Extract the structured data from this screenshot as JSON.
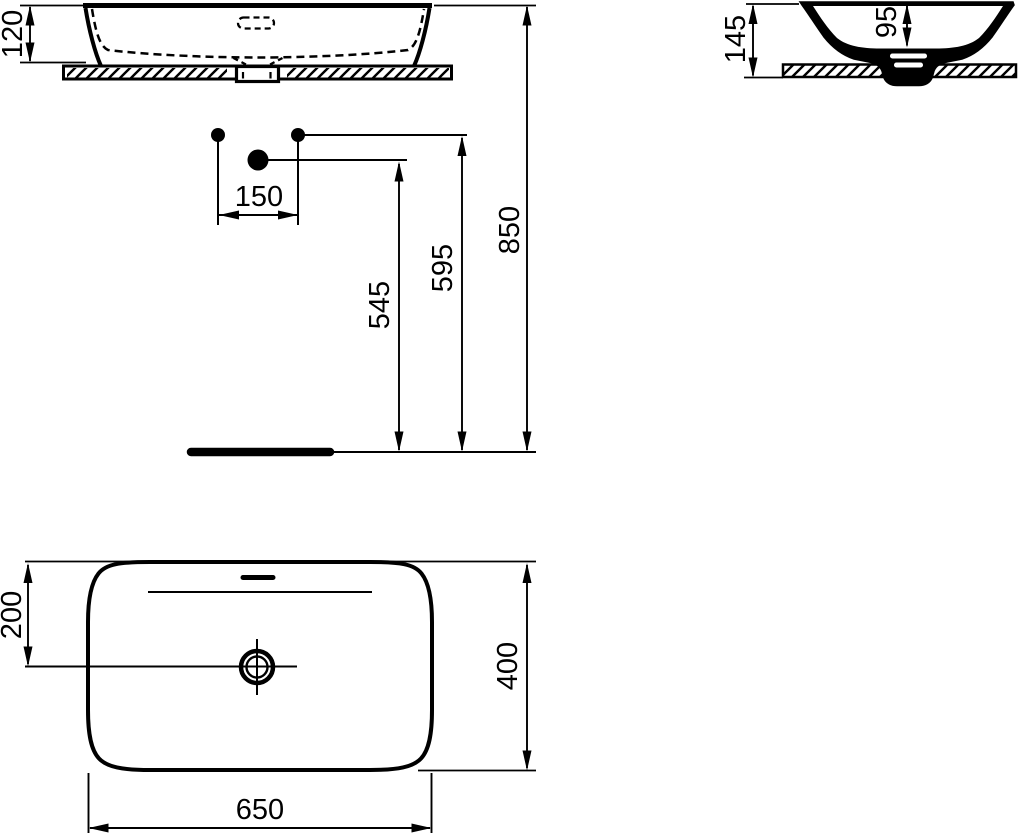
{
  "drawing": {
    "line_color": "#000000",
    "background": "#ffffff",
    "dims": {
      "rim_to_counter": "120",
      "overall_height": "145",
      "bowl_depth": "95",
      "connection_spacing": "150",
      "waste_outlet_height": "545",
      "supply_height": "595",
      "rim_above_floor": "850",
      "waste_center_offset": "200",
      "basin_depth": "400",
      "basin_width": "650"
    }
  }
}
